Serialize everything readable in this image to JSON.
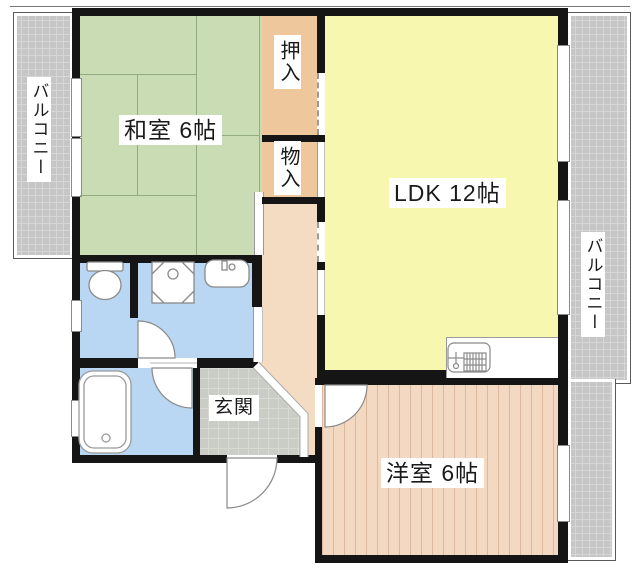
{
  "plan": {
    "type": "apartment-floor-plan",
    "rooms": {
      "washitsu": "和室 6帖",
      "ldk": "LDK 12帖",
      "yoshitsu": "洋室 6帖",
      "genkan": "玄関",
      "oshiire": "押入",
      "monoire": "物入",
      "balcony_left": "バルコニー",
      "balcony_right": "バルコニー"
    },
    "fixtures": [
      "toilet",
      "washing-machine-pan",
      "washbasin",
      "bathtub",
      "kitchen-sink",
      "hinged-door-arcs",
      "sliding-door-tracks",
      "windows",
      "genkan-step"
    ],
    "colors": {
      "tatami_green": "#c9dcb3",
      "ldk_yellow": "#f8f7b0",
      "closet_tan": "#eec79c",
      "hall_peach": "#f4dcc3",
      "western_room_tan": "#f3d9c1",
      "wet_area_blue": "#b9d6f2",
      "balcony_gray": "#c6c6c6",
      "genkan_gray": "#caccc6",
      "wall_black": "#151515"
    }
  }
}
